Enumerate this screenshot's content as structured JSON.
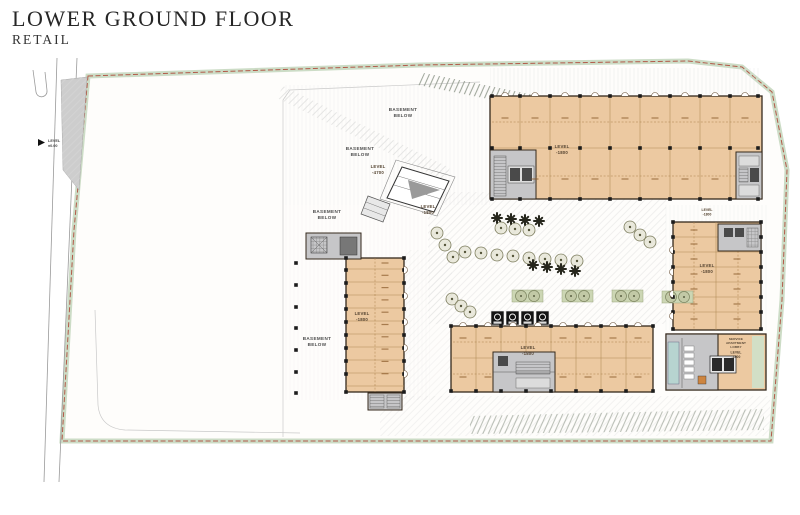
{
  "header": {
    "title": "LOWER GROUND FLOOR",
    "subtitle": "RETAIL"
  },
  "annotations": {
    "basement_top": {
      "line1": "BASEMENT",
      "line2": "BELOW"
    },
    "basement_mid": {
      "line1": "BASEMENT",
      "line2": "BELOW"
    },
    "basement_left_upper": {
      "line1": "BASEMENT",
      "line2": "BELOW"
    },
    "basement_left_lower": {
      "line1": "BASEMENT",
      "line2": "BELOW"
    },
    "level_4700": {
      "line1": "LEVEL",
      "line2": "-4700"
    },
    "ramp_level": {
      "line1": "LEVEL",
      "line2": "-1800"
    },
    "road_level": {
      "line1": "LEVEL",
      "line2": "±0.00"
    }
  },
  "buildings": {
    "north_retail": {
      "level_line1": "LEVEL",
      "level_line2": "-1800"
    },
    "east_retail": {
      "level_line1": "LEVEL",
      "level_line2": "-1800"
    },
    "east_retail_entry": {
      "level_line1": "LEVEL",
      "level_line2": "-1800"
    },
    "south_retail": {
      "level_line1": "LEVEL",
      "level_line2": "-1800"
    },
    "west_retail": {
      "level_line1": "LEVEL",
      "level_line2": "-1800"
    },
    "service_block": {
      "lobby_line1": "SERVICE",
      "lobby_line2": "APARTMENT",
      "lobby_line3": "LOBBY",
      "level_line1": "LEVEL",
      "level_line2": "-1800"
    }
  },
  "colors": {
    "retail_fill": "#ecc9a1",
    "core_fill": "#c6c6c8",
    "site_boundary": "#b25a49",
    "green_belt": "#ccdcc6",
    "planter": "#ccd6b4",
    "tree": "#7d7d5e",
    "water": "#b7d4d0",
    "ink": "#2b2b2b"
  }
}
